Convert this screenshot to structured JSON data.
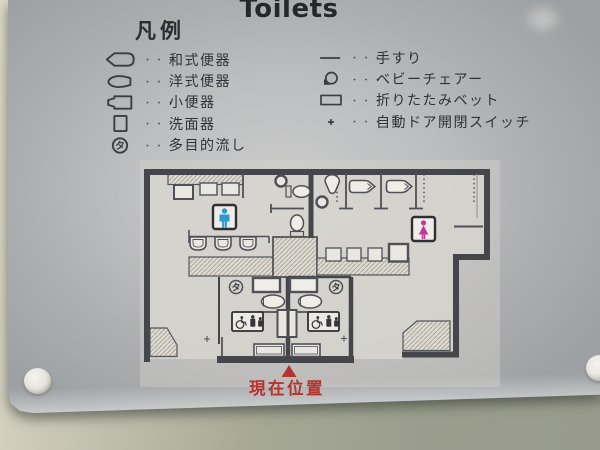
{
  "title": "Toilets",
  "legend": {
    "heading": "凡例",
    "dots": "・・・",
    "left_items": [
      {
        "icon": "squat-toilet",
        "label": "和式便器"
      },
      {
        "icon": "western-toilet",
        "label": "洋式便器"
      },
      {
        "icon": "urinal",
        "label": "小便器"
      },
      {
        "icon": "washbasin",
        "label": "洗面器"
      },
      {
        "icon": "multipurpose-sink",
        "label": "多目的流し",
        "symbol": "タ"
      }
    ],
    "right_items": [
      {
        "icon": "handrail",
        "label": "手すり"
      },
      {
        "icon": "baby-chair",
        "label": "ベビーチェアー"
      },
      {
        "icon": "folding-bed",
        "label": "折りたたみベット"
      },
      {
        "icon": "auto-door-switch",
        "label": "自動ドア開閉スイッチ"
      }
    ]
  },
  "map": {
    "current_location_label": "現在位置",
    "multipurpose_symbol": "タ",
    "mens_symbol_color": "#2f9ad0",
    "womens_symbol_color": "#c23a97",
    "marker_color": "#b5342f"
  }
}
